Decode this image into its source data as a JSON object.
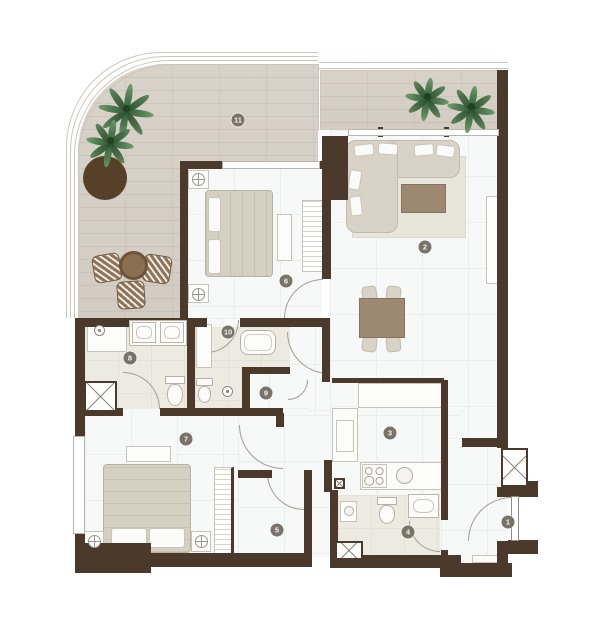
{
  "type": "apartment-floor-plan",
  "rooms": [
    {
      "number": "1",
      "key": "entrance-hall"
    },
    {
      "number": "2",
      "key": "living-dining"
    },
    {
      "number": "3",
      "key": "kitchen"
    },
    {
      "number": "4",
      "key": "guest-bathroom"
    },
    {
      "number": "5",
      "key": "dressing-room"
    },
    {
      "number": "6",
      "key": "bedroom-1"
    },
    {
      "number": "7",
      "key": "bedroom-2"
    },
    {
      "number": "8",
      "key": "bathroom"
    },
    {
      "number": "9",
      "key": "hall"
    },
    {
      "number": "10",
      "key": "ensuite-bathroom"
    },
    {
      "number": "11",
      "key": "terrace"
    }
  ],
  "colors": {
    "wall": "#4b3a2b",
    "wood_floor": "#d6cfc6",
    "marble_floor": "#f7f8f8",
    "bath_floor": "#edeae2",
    "plant_green": "#49784b",
    "furniture_wood": "#9d8872",
    "upholstery": "#d8d3c6",
    "planter_brown": "#57402a"
  }
}
